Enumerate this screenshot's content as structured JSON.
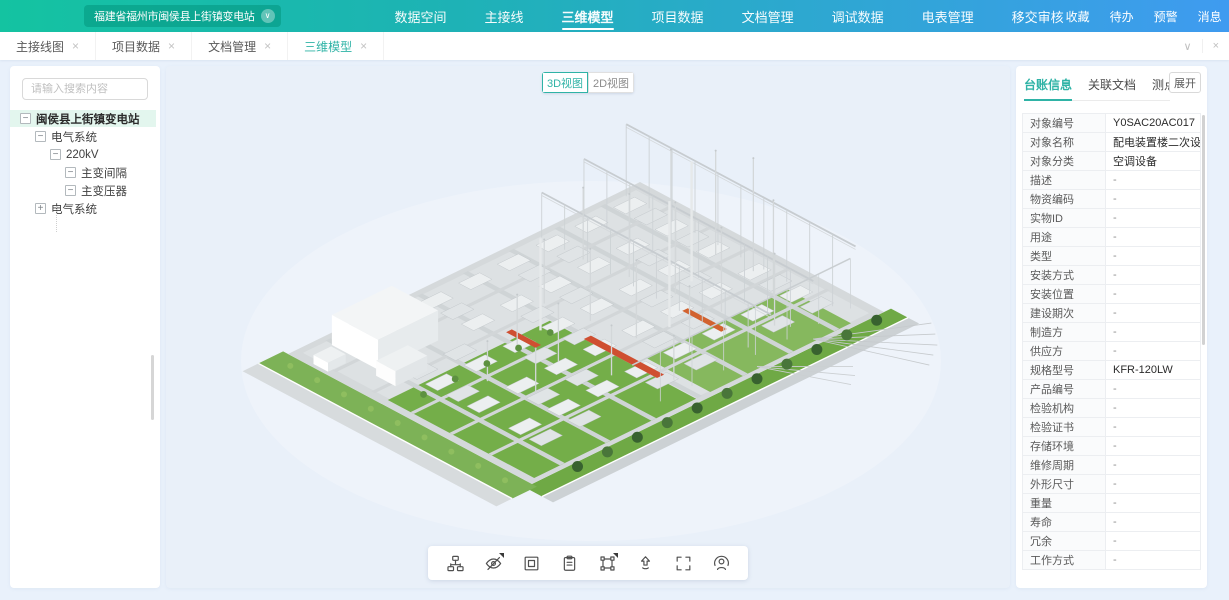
{
  "glyphs": {
    "close": "×",
    "chevron_down": "∨",
    "expand_minus": "−",
    "expand_plus": "+"
  },
  "colors": {
    "accent": "#2fb3a6",
    "header_left": "#14c3a1",
    "header_right": "#3f9bf0",
    "page_bg": "#e9f1fb",
    "lawn": "#74ae49",
    "alert_red": "#cf4f31"
  },
  "header": {
    "station_selector": "福建省福州市闽侯县上街镇变电站",
    "nav": [
      {
        "label": "数据空间",
        "active": false
      },
      {
        "label": "主接线",
        "active": false
      },
      {
        "label": "三维模型",
        "active": true
      },
      {
        "label": "项目数据",
        "active": false
      },
      {
        "label": "文档管理",
        "active": false
      },
      {
        "label": "调试数据",
        "active": false
      },
      {
        "label": "电表管理",
        "active": false
      },
      {
        "label": "移交审核",
        "active": false
      }
    ],
    "quick_links": [
      {
        "label": "收藏"
      },
      {
        "label": "待办"
      },
      {
        "label": "预警"
      },
      {
        "label": "消息"
      }
    ],
    "account_name": "测试账号"
  },
  "tabbar": {
    "tabs": [
      {
        "label": "主接线图",
        "active": false
      },
      {
        "label": "项目数据",
        "active": false
      },
      {
        "label": "文档管理",
        "active": false
      },
      {
        "label": "三维模型",
        "active": true
      }
    ]
  },
  "sidebar": {
    "search_placeholder": "请输入搜索内容",
    "tree": [
      {
        "label": "闽侯县上街镇变电站",
        "level": 0,
        "expand": "minus",
        "selected": true
      },
      {
        "label": "电气系统",
        "level": 1,
        "expand": "minus",
        "selected": false
      },
      {
        "label": "220kV",
        "level": 2,
        "expand": "minus",
        "selected": false
      },
      {
        "label": "主变间隔",
        "level": 3,
        "expand": "minus",
        "selected": false
      },
      {
        "label": "主变压器",
        "level": 3,
        "expand": "minus",
        "selected": false
      },
      {
        "label": "电气系统",
        "level": 1,
        "expand": "plus",
        "selected": false
      }
    ]
  },
  "viewport": {
    "view_toggle": [
      {
        "label": "3D视图",
        "active": true
      },
      {
        "label": "2D视图",
        "active": false
      }
    ],
    "toolbar": [
      {
        "icon": "hierarchy",
        "corner": false
      },
      {
        "icon": "eye-off",
        "corner": true
      },
      {
        "icon": "box-select",
        "corner": false
      },
      {
        "icon": "clipboard",
        "corner": false
      },
      {
        "icon": "transform",
        "corner": true
      },
      {
        "icon": "arrow-up",
        "corner": false
      },
      {
        "icon": "fullscreen",
        "corner": false
      },
      {
        "icon": "person-view",
        "corner": false
      }
    ]
  },
  "panel": {
    "tabs": [
      {
        "label": "台账信息",
        "active": true
      },
      {
        "label": "关联文档",
        "active": false
      },
      {
        "label": "测点",
        "active": false
      }
    ],
    "expand_button": "展开",
    "fields": [
      [
        "对象编号",
        "Y0SAC20AC017"
      ],
      [
        "对象名称",
        "配电装置楼二次设备室柜式空..."
      ],
      [
        "对象分类",
        "空调设备"
      ],
      [
        "描述",
        "-"
      ],
      [
        "物资编码",
        "-"
      ],
      [
        "实物ID",
        "-"
      ],
      [
        "用途",
        "-"
      ],
      [
        "类型",
        "-"
      ],
      [
        "安装方式",
        "-"
      ],
      [
        "安装位置",
        "-"
      ],
      [
        "建设期次",
        "-"
      ],
      [
        "制造方",
        "-"
      ],
      [
        "供应方",
        "-"
      ],
      [
        "规格型号",
        "KFR-120LW"
      ],
      [
        "产品编号",
        "-"
      ],
      [
        "检验机构",
        "-"
      ],
      [
        "检验证书",
        "-"
      ],
      [
        "存储环境",
        "-"
      ],
      [
        "维修周期",
        "-"
      ],
      [
        "外形尺寸",
        "-"
      ],
      [
        "重量",
        "-"
      ],
      [
        "寿命",
        "-"
      ],
      [
        "冗余",
        "-"
      ],
      [
        "工作方式",
        "-"
      ]
    ]
  }
}
